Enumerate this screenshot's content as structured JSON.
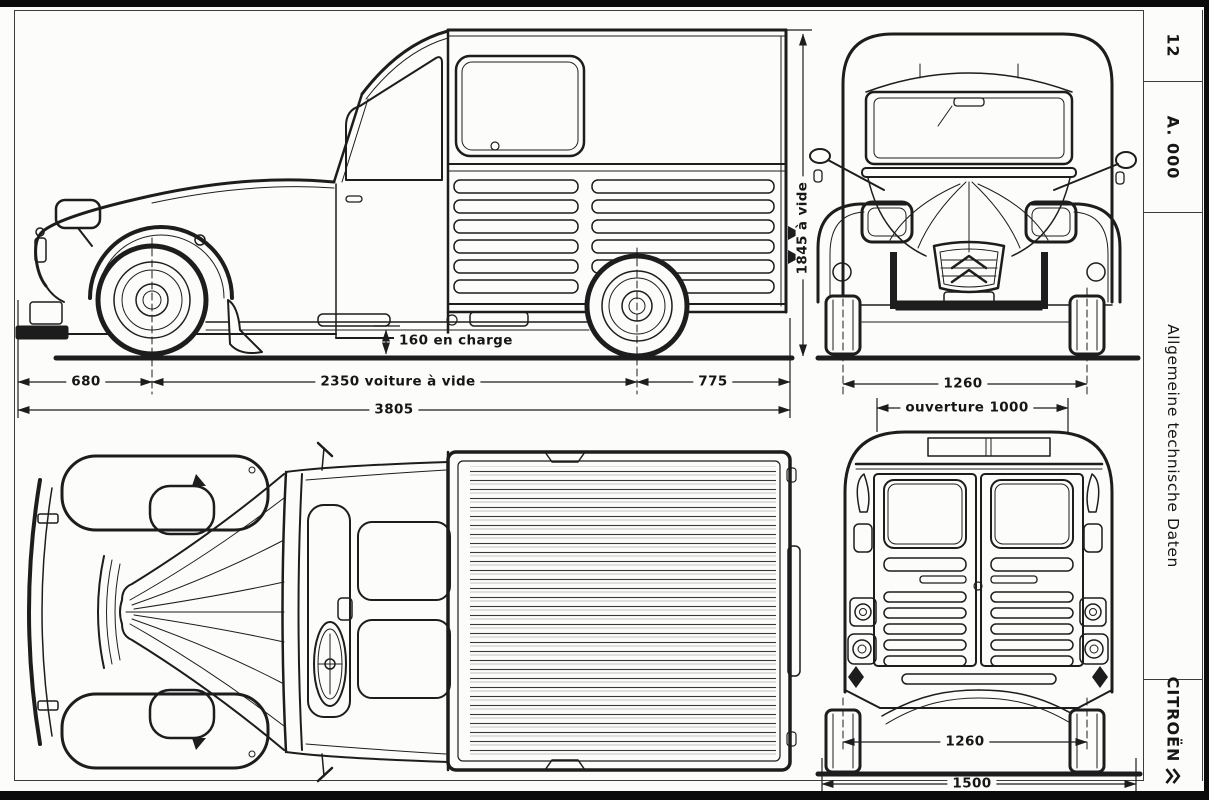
{
  "sidebar": {
    "page_number": "12",
    "section_code": "A. 000",
    "section_title": "Allgemeine technische Daten",
    "brand": "CITROËN"
  },
  "dimensions": {
    "side_view": {
      "front_overhang": "680",
      "wheelbase": "2350 voiture à vide",
      "rear_overhang": "775",
      "overall_length": "3805",
      "ground_clearance": "160 en charge",
      "overall_height": "1845 à vide"
    },
    "front_view": {
      "track": "1260",
      "door_opening": "ouverture 1000"
    },
    "rear_view": {
      "track": "1260",
      "overall_width": "1500"
    }
  },
  "colors": {
    "ink": "#1d1d1d",
    "paper": "#fcfcfa"
  }
}
